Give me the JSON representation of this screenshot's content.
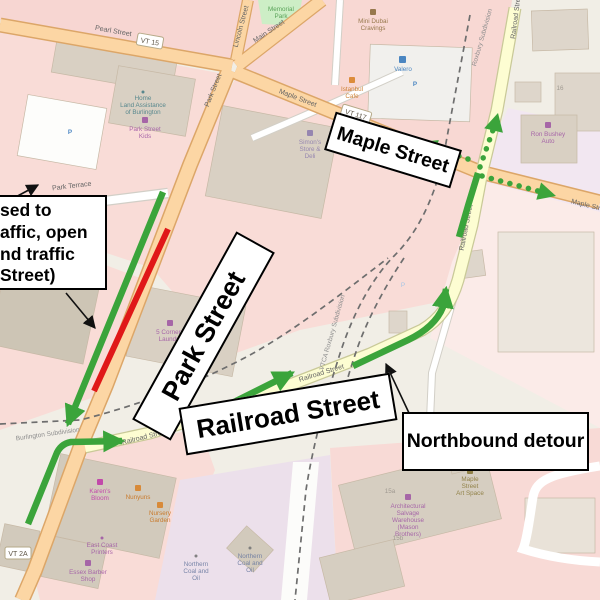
{
  "annotations": {
    "park_street": "Park Street",
    "maple_street": "Maple Street",
    "railroad_street": "Railroad Street",
    "northbound_detour": "Northbound detour",
    "closure_note_lines": [
      "sed to",
      "affic, open",
      "nd traffic",
      "Street)"
    ]
  },
  "legend_colors": {
    "detour_green": "#3ba43b",
    "closed_red": "#e01818"
  },
  "map": {
    "streets": {
      "pearl": "Pearl Street",
      "vt15": "VT 15",
      "lincoln": "Lincoln Street",
      "main": "Main Street",
      "maple_a": "Maple Street",
      "vt117": "VT 117",
      "park_a": "Park Street",
      "park_terrace": "Park Terrace",
      "railroad_a": "Railroad Street",
      "railroad_b": "Railroad Street",
      "railroad_c": "Railroad Street",
      "railroad_d": "Railroad Street",
      "maple_b": "Maple Street",
      "vt2a": "VT 2A"
    },
    "railways": {
      "burlington": "Burlington Subdivision",
      "roxbury": "Roxbury Subdivision",
      "vtca_roxbury": "VTCA Roxbury Subdivision"
    },
    "pois": {
      "memorial_park": [
        "Memorial",
        "Park"
      ],
      "mini_dubai": [
        "Mini Dubai",
        "Cravings"
      ],
      "land_assistance": [
        "Home",
        "Land Assistance",
        "of Burlington"
      ],
      "park_street_kids": [
        "Park Street",
        "Kids"
      ],
      "istanbul_cafe": [
        "Istanbul",
        "Cafe"
      ],
      "valero": [
        "Valero"
      ],
      "simons": [
        "Simon's",
        "Store &",
        "Deli"
      ],
      "laundry": [
        "5 Corners",
        "Laundry"
      ],
      "ron_bushey": [
        "Ron Bushey",
        "Auto"
      ],
      "karens_bloom": [
        "Karen's",
        "Bloom"
      ],
      "nunyuns": [
        "Nunyuns"
      ],
      "nursery_garden": [
        "Nursery",
        "Garden"
      ],
      "east_coast_printers": [
        "East Coast",
        "Printers"
      ],
      "essex_barber": [
        "Essex Barber",
        "Shop"
      ],
      "northern_coal_1": [
        "Northern",
        "Coal and",
        "Oil"
      ],
      "northern_coal_2": [
        "Northern",
        "Coal and",
        "Oil"
      ],
      "maple_art_space": [
        "Maple",
        "Street",
        "Art Space"
      ],
      "arch_salvage": [
        "Architectural",
        "Salvage",
        "Warehouse",
        "(Mason",
        "Brothers)"
      ],
      "parking": "P",
      "num_16": "16",
      "num_15a": "15a",
      "num_15b": "15b"
    }
  }
}
